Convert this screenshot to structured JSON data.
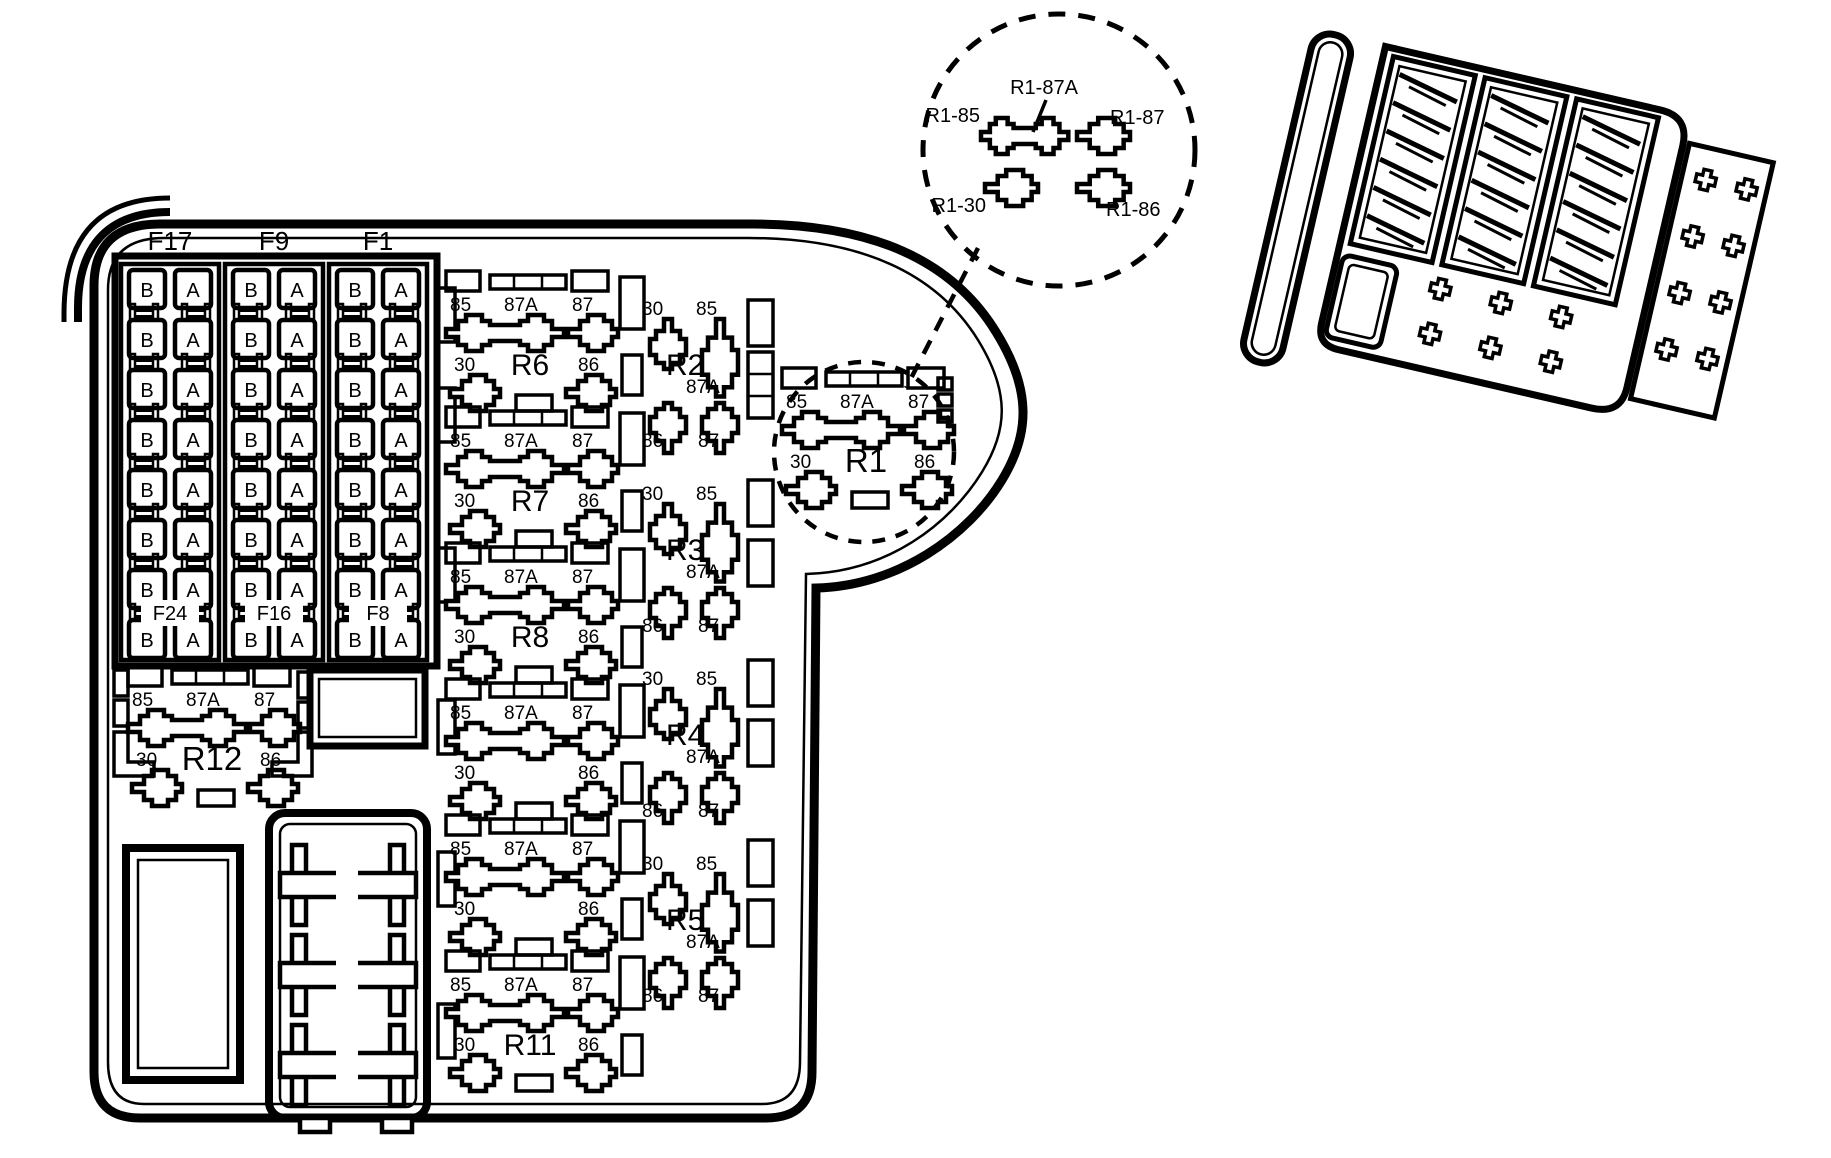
{
  "figure": {
    "kind": "battery-junction-box-fuse-relay-diagram"
  },
  "colors": {
    "line": "#000000",
    "background": "#ffffff"
  },
  "detail_callout": {
    "labels": {
      "r85": "R1-85",
      "r87a": "R1-87A",
      "r87": "R1-87",
      "r30": "R1-30",
      "r86": "R1-86"
    }
  },
  "fuse_panel": {
    "column_headers": [
      "F17",
      "F9",
      "F1"
    ],
    "column_overlay_labels": [
      "F24",
      "F16",
      "F8"
    ],
    "rows_per_column": 8,
    "fuse_letters": [
      "B",
      "A"
    ]
  },
  "relay_pins": {
    "top": [
      "85",
      "87A",
      "87"
    ],
    "bottom": [
      "30",
      "86"
    ],
    "vertical_top": [
      "30",
      "85"
    ],
    "vertical_mid": "87A",
    "vertical_bottom": [
      "86",
      "87"
    ]
  },
  "relays": {
    "horizontal_names": [
      "R6",
      "R7",
      "R8",
      "",
      "",
      "R11"
    ],
    "vertical_names": [
      "R2",
      "R3",
      "R4",
      "R5"
    ],
    "r1": "R1",
    "r12": "R12"
  }
}
